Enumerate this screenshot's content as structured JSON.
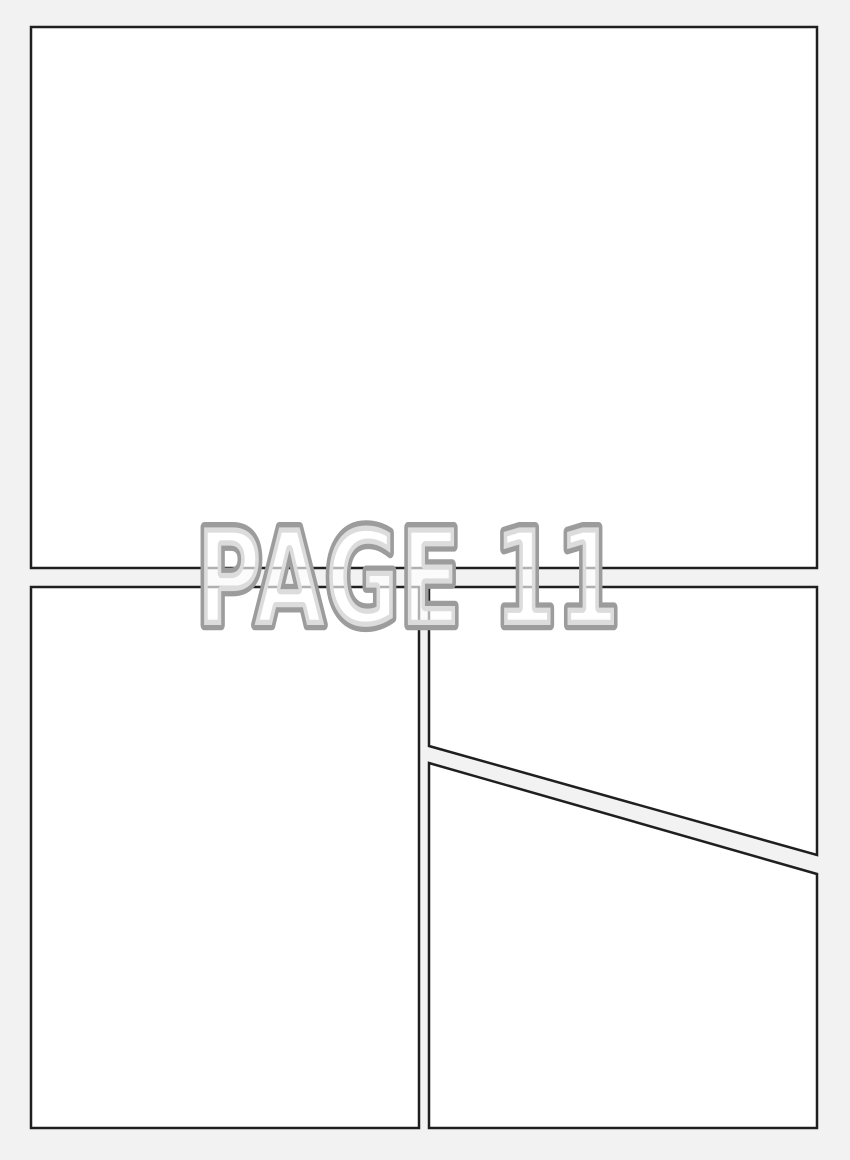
{
  "page": {
    "watermark": "PAGE 11"
  },
  "colors": {
    "background": "#f2f2f2",
    "panel_fill": "#ffffff",
    "panel_border": "#1f1f1f",
    "watermark_outline": "#9c9c9c",
    "watermark_fill": "#ffffff"
  }
}
